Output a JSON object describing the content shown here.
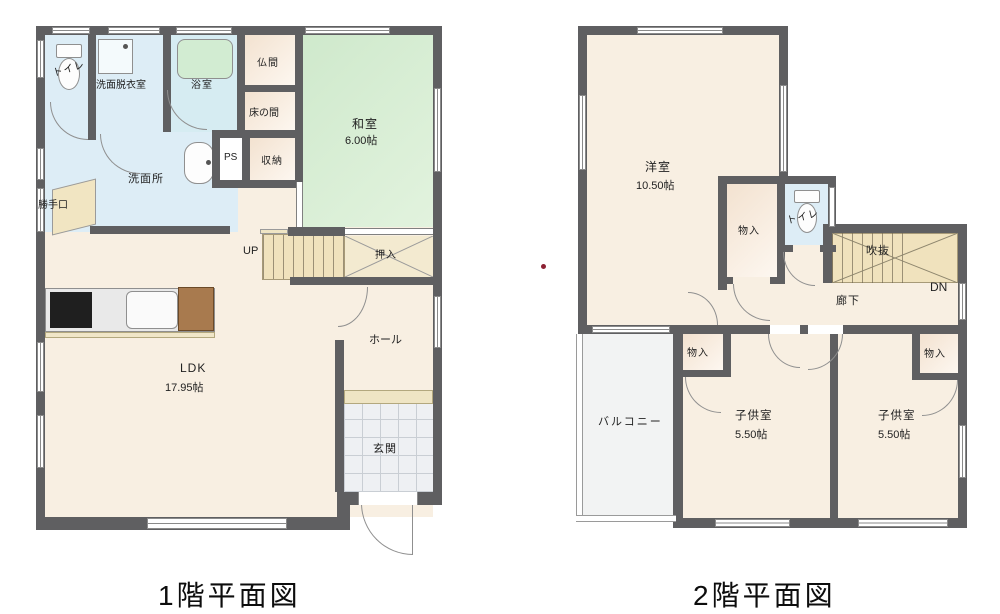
{
  "floor1": {
    "title": "1階平面図",
    "labels": {
      "toilet": "トイレ",
      "senmen_datsui": "洗面脱衣室",
      "bath": "浴室",
      "butsuma": "仏間",
      "tokonoma": "床の間",
      "ps": "PS",
      "shuno": "収納",
      "washitsu": "和室",
      "washitsu_size": "6.00帖",
      "senmenjo": "洗面所",
      "katteguchi": "勝手口",
      "up": "UP",
      "oshiire": "押入",
      "hall": "ホール",
      "ldk": "LDK",
      "ldk_size": "17.95帖",
      "genkan": "玄関"
    }
  },
  "floor2": {
    "title": "2階平面図",
    "labels": {
      "yoshitsu": "洋室",
      "yoshitsu_size": "10.50帖",
      "monoire_hall": "物入",
      "toilet": "トイレ",
      "fukinuke": "吹抜",
      "dn": "DN",
      "rouka": "廊下",
      "balcony": "バルコニー",
      "monoire_left": "物入",
      "kodomo_left": "子供室",
      "kodomo_left_size": "5.50帖",
      "monoire_right": "物入",
      "kodomo_right": "子供室",
      "kodomo_right_size": "5.50帖"
    }
  },
  "colors": {
    "wall": "#5f5f61",
    "floor_cream": "#f8efe2",
    "tatami_green": "#d8eed3",
    "wet_blue": "#ddedf6",
    "stair_beige": "#f0e2bd",
    "closet_beige": "#f3e2d0",
    "entry_tile": "#eef0f3",
    "balcony_gray": "#f2f3f3",
    "fridge_brown": "#a87a4e",
    "accent_dot": "#8d2133"
  }
}
